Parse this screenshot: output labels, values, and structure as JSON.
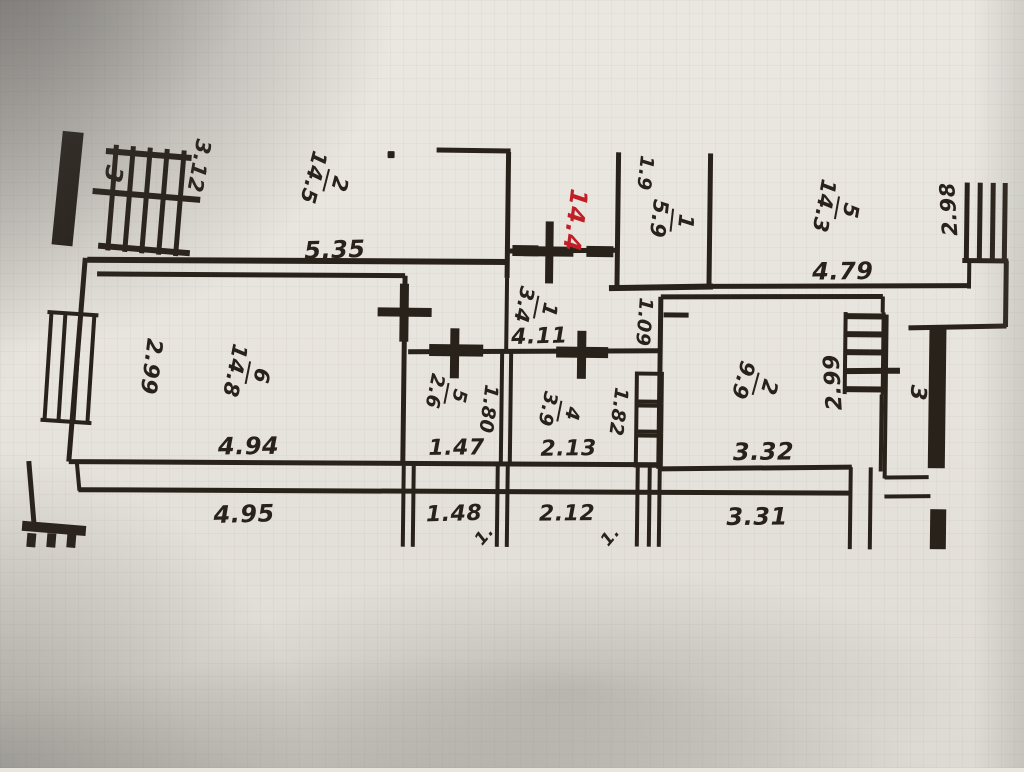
{
  "meta": {
    "description": "Photograph of a paper apartment floor plan (BTI scheme) with drafted room numbers, areas and dimensions in metres; one value added by hand in red ink"
  },
  "colors": {
    "ink": "#29221b",
    "red_ink": "#c01f26",
    "paper": "#e7e4dd",
    "shadow": "#8e8b86"
  },
  "rooms": {
    "balcony_left": {
      "number": "3"
    },
    "r2_left": {
      "number": "2",
      "area": "14.5"
    },
    "r1": {
      "number": "1",
      "area": "5.9"
    },
    "r5_top_right": {
      "number": "5",
      "area": "14.3"
    },
    "r6": {
      "number": "6",
      "area": "14.8"
    },
    "r5_small": {
      "number": "5",
      "area": "2.6"
    },
    "r4": {
      "number": "4",
      "area": "3.9"
    },
    "hall": {
      "number": "1",
      "area": "3.4"
    },
    "r2_right": {
      "number": "2",
      "area": "9.9"
    },
    "balcony_right": {
      "number": "3"
    }
  },
  "dims": {
    "red_note": "14.4",
    "d3_12": "3.12",
    "d5_35": "5.35",
    "d1_9": "1.9",
    "d4_79": "4.79",
    "d2_98": "2.98",
    "d2_99_l": "2.99",
    "d4_94": "4.94",
    "d1_80": "1.80",
    "d1_47": "1.47",
    "d4_11": "4.11",
    "d1_09": "1.09",
    "d1_82": "1.82",
    "d2_13": "2.13",
    "d2_99_r": "2.99",
    "d3_32": "3.32",
    "d4_95": "4.95",
    "d1_48": "1.48",
    "d2_12": "2.12",
    "d3_31": "3.31",
    "frag_a": "1.",
    "frag_b": "1."
  }
}
